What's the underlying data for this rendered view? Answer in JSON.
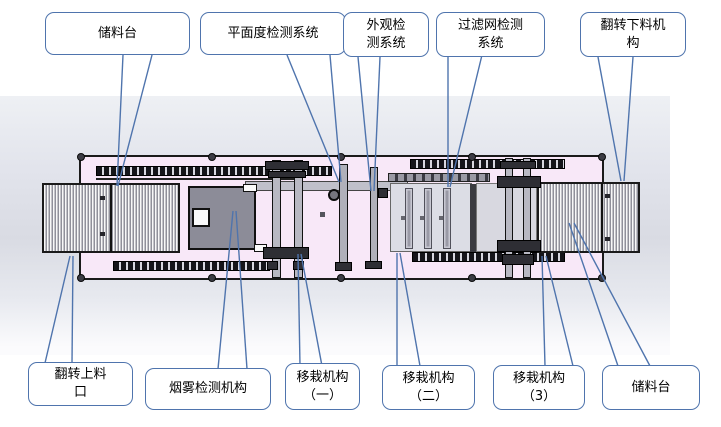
{
  "diagram": {
    "kind": "production-line layout, top view with labeled callouts",
    "colors": {
      "callout_border": "#4f74ad",
      "leader_line": "#4f74ad",
      "deck_pink": "#f8e8f8",
      "band_gray": "#dcdee6",
      "machine_outline": "#1a1a1a",
      "smoke_body_gray": "#8c8c98",
      "conveyor_stripe_gray": "#90909a"
    }
  },
  "callouts": [
    {
      "id": "top-storage",
      "text": "储料台"
    },
    {
      "id": "top-flatness",
      "text": "平面度检测系统"
    },
    {
      "id": "top-appearance",
      "text": "外观检\n测系统"
    },
    {
      "id": "top-filter",
      "text": "过滤网检测\n系统"
    },
    {
      "id": "top-flip-unload",
      "text": "翻转下料机\n构"
    },
    {
      "id": "bottom-flip-load",
      "text": "翻转上料\n口"
    },
    {
      "id": "bottom-smoke",
      "text": "烟雾检测机构"
    },
    {
      "id": "bottom-transfer1",
      "text": "移栽机构\n（一）"
    },
    {
      "id": "bottom-transfer2",
      "text": "移栽机构\n（二）"
    },
    {
      "id": "bottom-transfer3",
      "text": "移栽机构\n（3）"
    },
    {
      "id": "bottom-storage",
      "text": "储料台"
    }
  ],
  "machine": {
    "components": [
      "storage-conveyor-left",
      "flip-loading-port",
      "smoke-detection-unit",
      "transfer-mechanism-1",
      "flatness-detection-probe",
      "appearance-detection-probe",
      "filter-screen-slots",
      "transfer-mechanism-2",
      "transfer-mechanism-3",
      "flip-unloading-conveyor",
      "storage-conveyor-right"
    ]
  }
}
